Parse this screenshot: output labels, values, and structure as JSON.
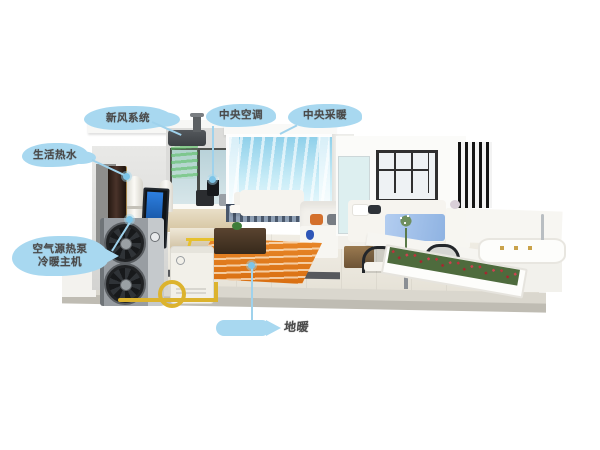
{
  "labels": {
    "fresh_air": "新风系统",
    "central_ac": "中央空调",
    "central_heating": "中央采暖",
    "hot_water": "生活热水",
    "heat_pump_line1": "空气源热泵",
    "heat_pump_line2": "冷暖主机",
    "floor_heating": "地暖"
  },
  "colors": {
    "callout_blue": "#a8d8f0",
    "leader_blue": "#9fd2ec",
    "label_text": "#4a4a4a",
    "pipe_yellow": "#dcb32e",
    "floor_heating_orange": "#e0791c",
    "fresh_air_green": "#5cb85c",
    "cool_air_cyan": "#9fd8ee",
    "heat_pump_gray": "#8a9096",
    "background": "#ffffff"
  }
}
